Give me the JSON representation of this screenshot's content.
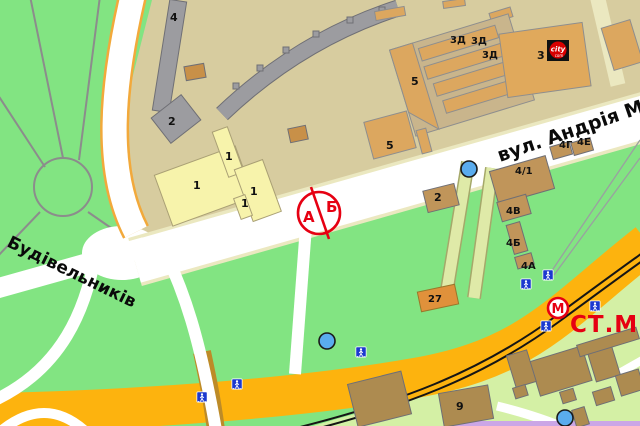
{
  "map": {
    "colors": {
      "base_green": "#82E482",
      "light_green": "#D4F0A5",
      "block_khaki": "#D7CC9F",
      "road_white": "#FFFFFF",
      "road_pale_edge": "#EBE8C0",
      "road_orange_main": "#FDB30E",
      "road_side_orange_edge": "#F2A93B",
      "tree_road_edge": "#BD8B28",
      "rail_black": "#151515",
      "building_gray": "#9C9CA0",
      "building_tan": "#DCA75F",
      "building_shell": "#C9B58C",
      "building_yellow": "#F7F3AB",
      "building_brown": "#C0955A",
      "building_brown_dark": "#AD8B50",
      "building_27_orange": "#E0913B",
      "lavender_line": "#CBA6E6",
      "marker_red": "#E60012",
      "sign_blue": "#1C39CF",
      "stop_dot_blue": "#5AACEE",
      "path_band": "#DFEAA8",
      "label_black": "#111111"
    },
    "street_labels": [
      {
        "name": "street-label-budivelnykiv",
        "text": "Будівельників",
        "x": 6,
        "y": 246,
        "size": 17,
        "weight": "bold",
        "color": "#0a0a0a",
        "rot": 26
      },
      {
        "name": "street-label-andriya",
        "text": "вул. Андрія Ма",
        "x": 500,
        "y": 162,
        "size": 19,
        "weight": "bold",
        "color": "#0a0a0a",
        "rot": -19
      }
    ],
    "metro": {
      "symbol": "М",
      "station_text": "СТ.М.",
      "x": 558,
      "y": 308,
      "text_x": 570,
      "text_y": 332,
      "color": "#E60012"
    },
    "boundary_marker": {
      "left": "А",
      "right": "Б",
      "cx": 319,
      "cy": 213,
      "r": 21,
      "ax": 303,
      "ay": 222,
      "bx": 326,
      "by": 212,
      "color": "#E60012"
    },
    "city_logo": {
      "text": "city",
      "sub": "com",
      "x": 558,
      "y": 50
    },
    "building_labels": [
      {
        "name": "label-bld-4",
        "text": "4",
        "x": 170,
        "y": 21,
        "size": 11
      },
      {
        "name": "label-bld-2-gray",
        "text": "2",
        "x": 168,
        "y": 125,
        "size": 11
      },
      {
        "name": "label-bld-1a",
        "text": "1",
        "x": 193,
        "y": 189,
        "size": 11
      },
      {
        "name": "label-bld-1b",
        "text": "1",
        "x": 225,
        "y": 160,
        "size": 11
      },
      {
        "name": "label-bld-1c",
        "text": "1",
        "x": 250,
        "y": 195,
        "size": 11
      },
      {
        "name": "label-bld-1d",
        "text": "1",
        "x": 241,
        "y": 207,
        "size": 11
      },
      {
        "name": "label-bld-5a",
        "text": "5",
        "x": 411,
        "y": 85,
        "size": 11
      },
      {
        "name": "label-bld-5b",
        "text": "5",
        "x": 386,
        "y": 149,
        "size": 11
      },
      {
        "name": "label-bld-3",
        "text": "3",
        "x": 537,
        "y": 59,
        "size": 11
      },
      {
        "name": "label-bld-3d-1",
        "text": "3Д",
        "x": 450,
        "y": 43,
        "size": 10
      },
      {
        "name": "label-bld-3d-2",
        "text": "3Д",
        "x": 471,
        "y": 44,
        "size": 10
      },
      {
        "name": "label-bld-3d-3",
        "text": "3Д",
        "x": 482,
        "y": 58,
        "size": 10
      },
      {
        "name": "label-bld-2-brown",
        "text": "2",
        "x": 434,
        "y": 201,
        "size": 11
      },
      {
        "name": "label-bld-4-1",
        "text": "4/1",
        "x": 515,
        "y": 174,
        "size": 10
      },
      {
        "name": "label-bld-4g",
        "text": "4Г",
        "x": 559,
        "y": 148,
        "size": 10
      },
      {
        "name": "label-bld-4e",
        "text": "4Е",
        "x": 577,
        "y": 145,
        "size": 10
      },
      {
        "name": "label-bld-4v",
        "text": "4В",
        "x": 506,
        "y": 214,
        "size": 10
      },
      {
        "name": "label-bld-4b",
        "text": "4Б",
        "x": 506,
        "y": 246,
        "size": 10
      },
      {
        "name": "label-bld-4a",
        "text": "4А",
        "x": 521,
        "y": 269,
        "size": 10
      },
      {
        "name": "label-bld-27",
        "text": "27",
        "x": 428,
        "y": 302,
        "size": 10
      },
      {
        "name": "label-bld-9",
        "text": "9",
        "x": 456,
        "y": 410,
        "size": 11
      }
    ],
    "transit": {
      "crossing_signs": [
        {
          "x": 361,
          "y": 352
        },
        {
          "x": 237,
          "y": 384
        },
        {
          "x": 202,
          "y": 397
        },
        {
          "x": 526,
          "y": 284
        },
        {
          "x": 548,
          "y": 275
        },
        {
          "x": 595,
          "y": 306
        },
        {
          "x": 546,
          "y": 326
        }
      ],
      "stop_dots": [
        {
          "x": 469,
          "y": 169
        },
        {
          "x": 327,
          "y": 341
        },
        {
          "x": 565,
          "y": 418
        }
      ]
    }
  }
}
